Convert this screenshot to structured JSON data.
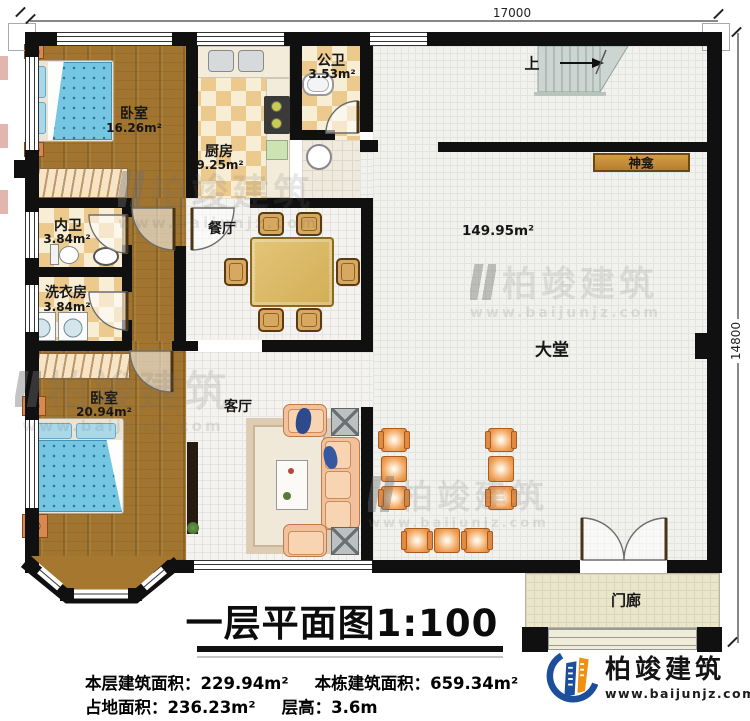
{
  "plan": {
    "dimensions": {
      "width": "17000",
      "height": "14800"
    },
    "rooms": {
      "bedroom1": {
        "name": "卧室",
        "area": "16.26m²"
      },
      "kitchen": {
        "name": "厨房",
        "area": "9.25m²"
      },
      "public_bath": {
        "name": "公卫",
        "area": "3.53m²"
      },
      "inner_bath": {
        "name": "内卫",
        "area": "3.84m²"
      },
      "laundry": {
        "name": "洗衣房",
        "area": "3.84m²"
      },
      "bedroom2": {
        "name": "卧室",
        "area": "20.94m²"
      },
      "dining": {
        "name": "餐厅"
      },
      "living": {
        "name": "客厅"
      },
      "hall": {
        "name": "大堂",
        "area": "149.95m²"
      },
      "shrine": {
        "name": "神龛"
      },
      "porch": {
        "name": "门廊"
      },
      "stairs": {
        "direction": "上"
      }
    }
  },
  "title": {
    "text": "一层平面图",
    "scale": "1:100"
  },
  "stats": {
    "items": [
      {
        "label": "本层建筑面积：",
        "value": "229.94m²"
      },
      {
        "label": "本栋建筑面积：",
        "value": "659.34m²"
      },
      {
        "label": "占地面积：",
        "value": "236.23m²"
      },
      {
        "label": "层高：",
        "value": "3.6m"
      }
    ]
  },
  "branding": {
    "logo_text": "柏竣建筑",
    "logo_url": "www.baijunjz.com"
  },
  "watermark": {
    "text": "柏竣建筑",
    "url": "www.baijunjz.com"
  }
}
